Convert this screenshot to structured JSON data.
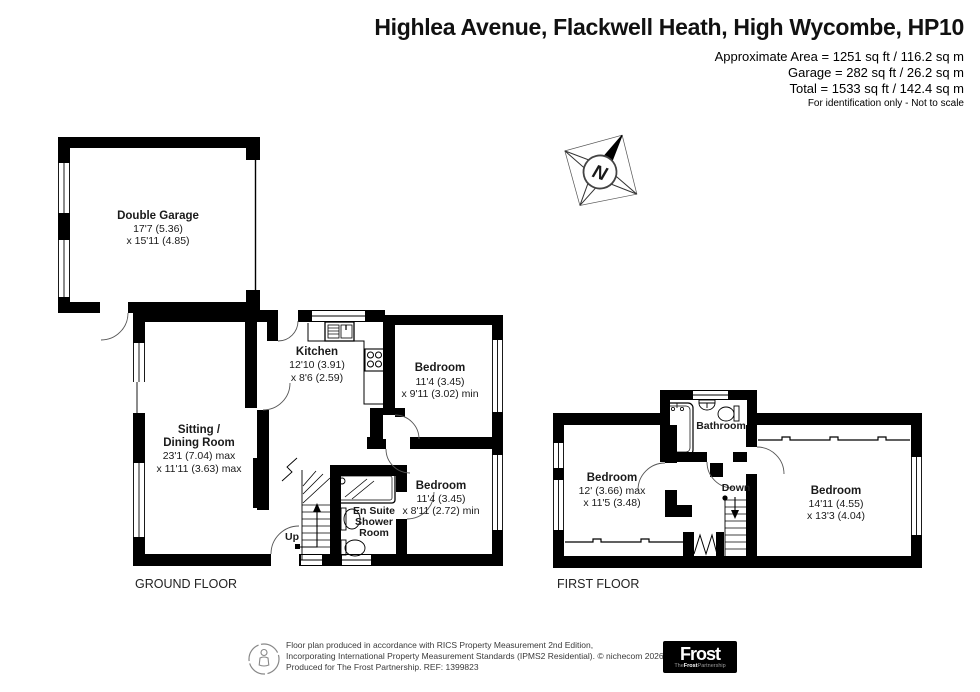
{
  "header": {
    "title": "Highlea Avenue, Flackwell Heath, High Wycombe, HP10",
    "area1": "Approximate Area = 1251 sq ft / 116.2 sq m",
    "area2": "Garage = 282 sq ft / 26.2 sq m",
    "area3": "Total = 1533 sq ft / 142.4 sq m",
    "disclaimer": "For identification only - Not to scale"
  },
  "compass": {
    "n": "N"
  },
  "ground_floor": {
    "label": "GROUND FLOOR",
    "up": "Up",
    "rooms": {
      "garage": {
        "name": "Double Garage",
        "dim1": "17'7 (5.36)",
        "dim2": "x 15'11 (4.85)"
      },
      "kitchen": {
        "name": "Kitchen",
        "dim1": "12'10 (3.91)",
        "dim2": "x 8'6 (2.59)"
      },
      "bedroom1": {
        "name": "Bedroom",
        "dim1": "11'4 (3.45)",
        "dim2": "x 9'11 (3.02) min"
      },
      "sitting": {
        "name1": "Sitting /",
        "name2": "Dining Room",
        "dim1": "23'1 (7.04) max",
        "dim2": "x 11'11 (3.63) max"
      },
      "bedroom2": {
        "name": "Bedroom",
        "dim1": "11'4 (3.45)",
        "dim2": "x 8'11 (2.72) min"
      },
      "ensuite": {
        "line1": "En Suite",
        "line2": "Shower",
        "line3": "Room"
      }
    }
  },
  "first_floor": {
    "label": "FIRST FLOOR",
    "down": "Down",
    "rooms": {
      "bedroom_left": {
        "name": "Bedroom",
        "dim1": "12' (3.66) max",
        "dim2": "x 11'5 (3.48)"
      },
      "bathroom": {
        "name": "Bathroom"
      },
      "bedroom_right": {
        "name": "Bedroom",
        "dim1": "14'11 (4.55)",
        "dim2": "x 13'3 (4.04)"
      }
    }
  },
  "footer": {
    "line1": "Floor plan produced in accordance with RICS Property Measurement 2nd Edition,",
    "line2": "Incorporating International Property Measurement Standards (IPMS2 Residential).   © nichecom 2026.",
    "line3": "Produced for The Frost Partnership.   REF:  1399823",
    "logo": {
      "main": "Frost",
      "sub_pre": "The",
      "sub_bold": "Frost",
      "sub_post": "Partnership"
    }
  },
  "colors": {
    "wall": "#000000",
    "background": "#ffffff",
    "logo_bg": "#000000"
  }
}
